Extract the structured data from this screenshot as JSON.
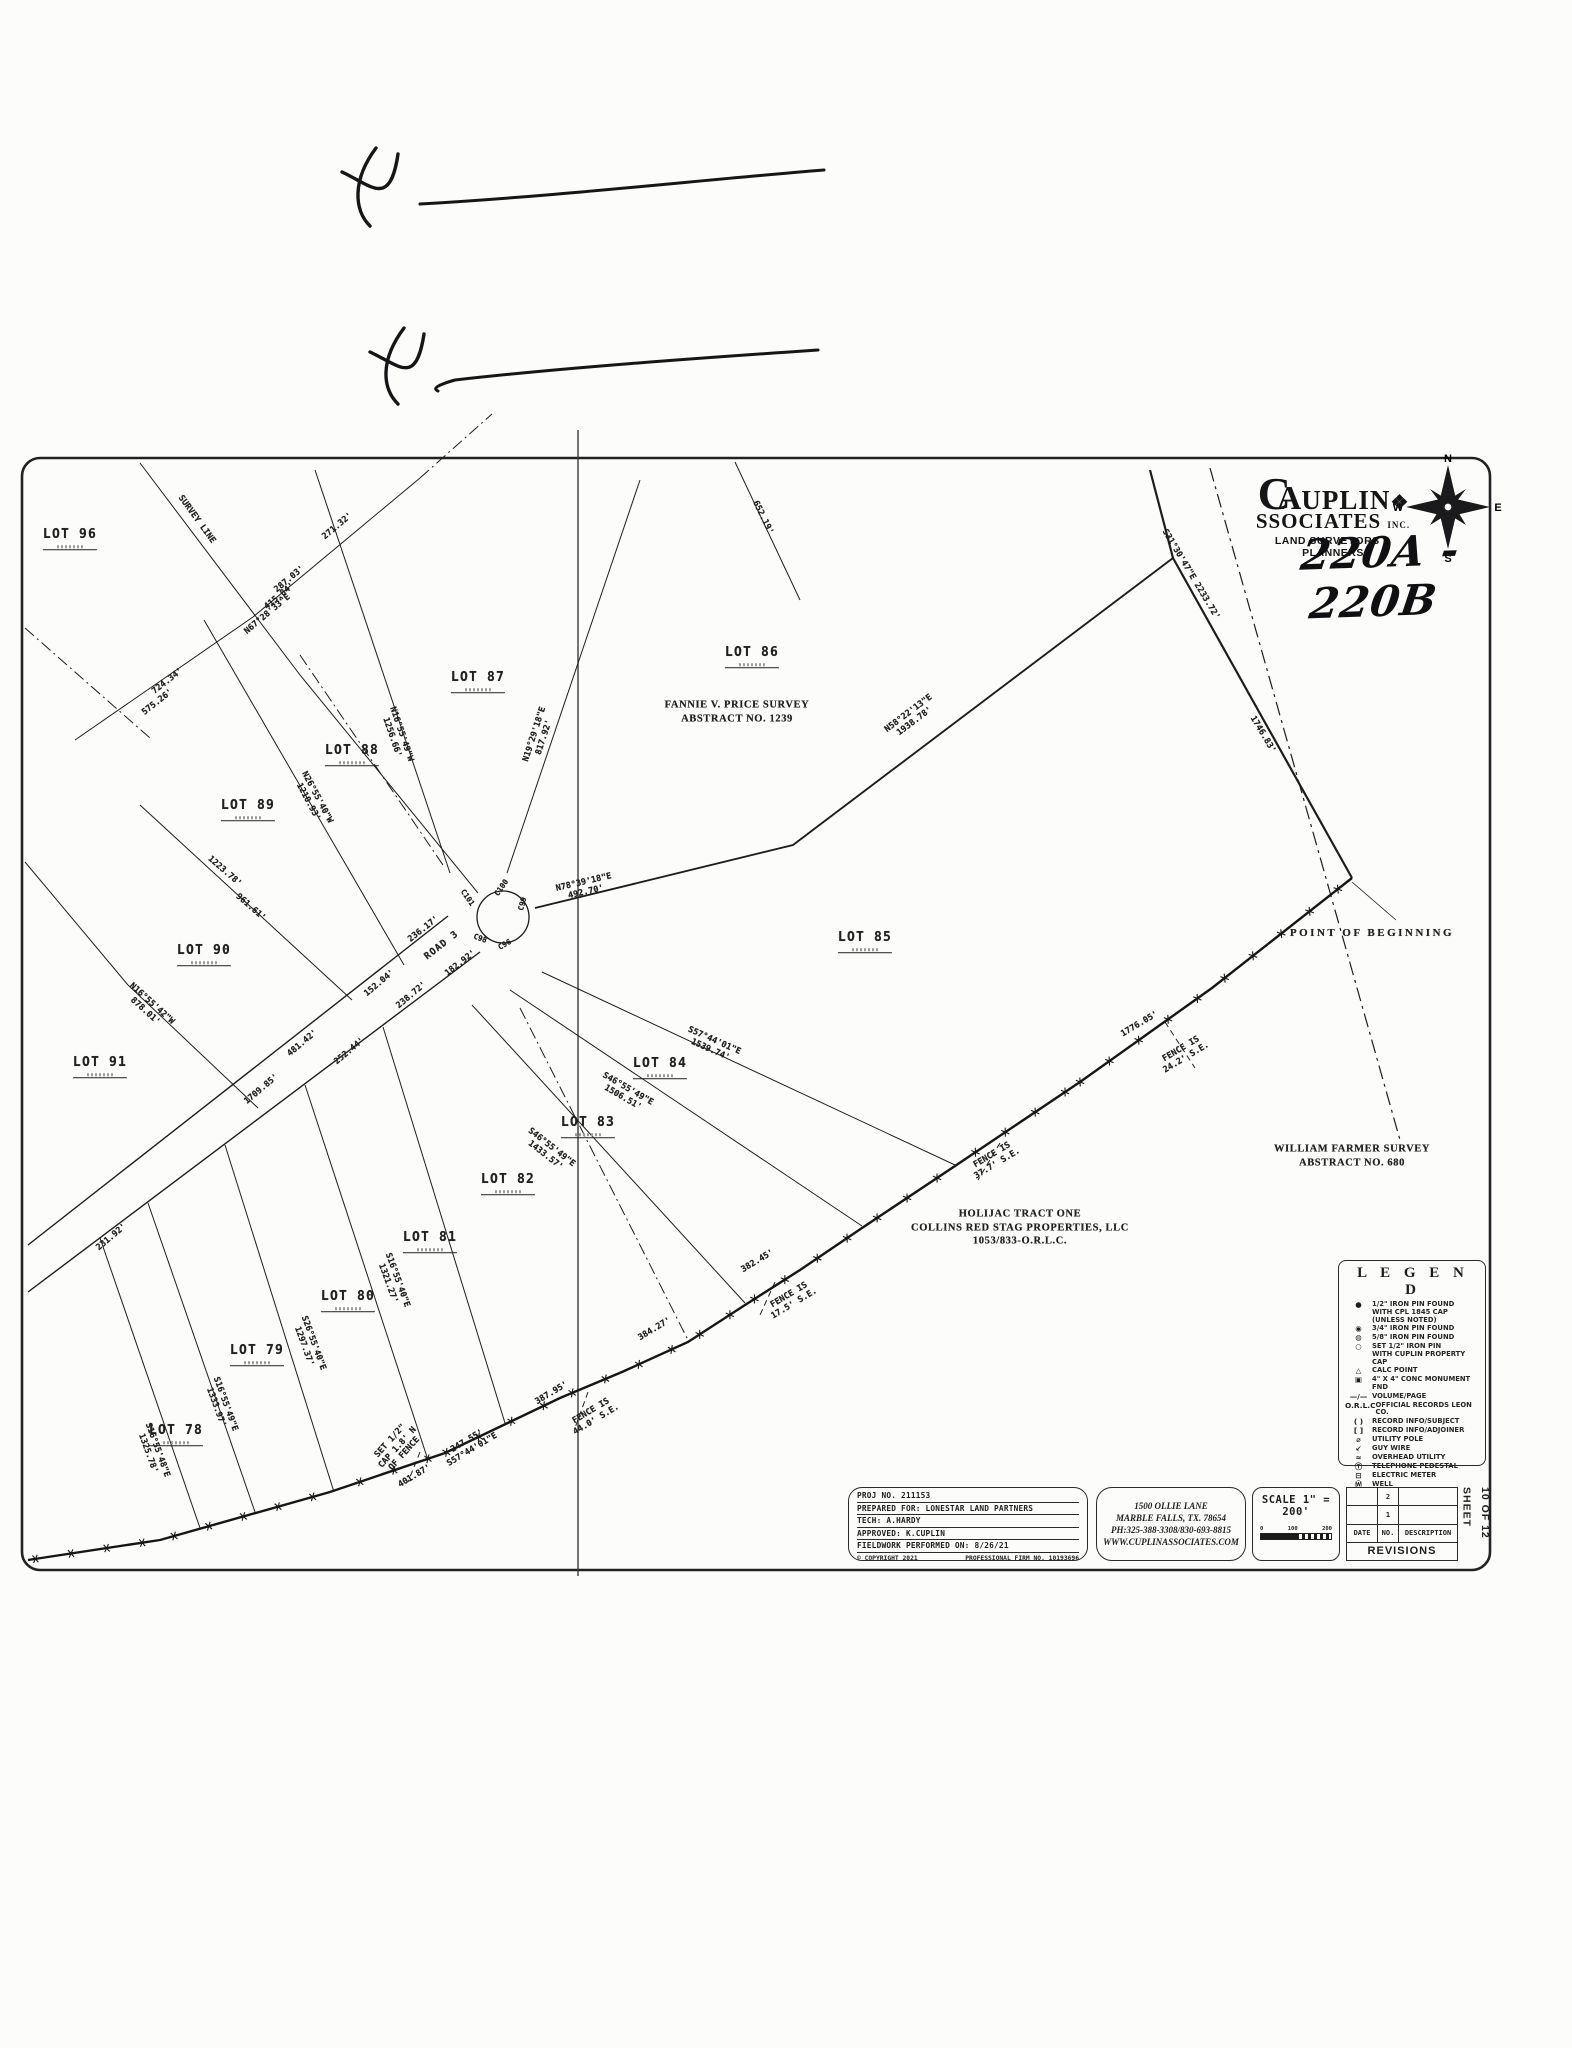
{
  "handwriting": {
    "plat_number": "220A - 220B",
    "x_mark_1": "X",
    "x_mark_2": "X"
  },
  "logo": {
    "monogram_c": "C",
    "monogram_a": "A",
    "name_rest": "UPLIN",
    "glyph": "❖",
    "line2_main": "SSOCIATES",
    "line2_suffix": "INC.",
    "tagline": "LAND SURVEYORS & PLANNERS"
  },
  "compass": {
    "north": "N",
    "south": "S",
    "east": "E",
    "west": "W"
  },
  "map": {
    "labels": [
      {
        "t": "LOT 96",
        "x": 70,
        "y": 539,
        "r": 0,
        "c": "lot"
      },
      {
        "t": "LOT 87",
        "x": 478,
        "y": 682,
        "r": 0,
        "c": "lot"
      },
      {
        "t": "LOT 88",
        "x": 352,
        "y": 755,
        "r": 0,
        "c": "lot"
      },
      {
        "t": "LOT 89",
        "x": 248,
        "y": 810,
        "r": 0,
        "c": "lot"
      },
      {
        "t": "LOT 90",
        "x": 204,
        "y": 955,
        "r": 0,
        "c": "lot"
      },
      {
        "t": "LOT 91",
        "x": 100,
        "y": 1067,
        "r": 0,
        "c": "lot"
      },
      {
        "t": "LOT 86",
        "x": 752,
        "y": 657,
        "r": 0,
        "c": "lot"
      },
      {
        "t": "LOT 85",
        "x": 865,
        "y": 942,
        "r": 0,
        "c": "lot"
      },
      {
        "t": "LOT 84",
        "x": 660,
        "y": 1068,
        "r": 0,
        "c": "lot"
      },
      {
        "t": "LOT 83",
        "x": 588,
        "y": 1127,
        "r": 0,
        "c": "lot"
      },
      {
        "t": "LOT 82",
        "x": 508,
        "y": 1184,
        "r": 0,
        "c": "lot"
      },
      {
        "t": "LOT 81",
        "x": 430,
        "y": 1242,
        "r": 0,
        "c": "lot"
      },
      {
        "t": "LOT 80",
        "x": 348,
        "y": 1301,
        "r": 0,
        "c": "lot"
      },
      {
        "t": "LOT 79",
        "x": 257,
        "y": 1355,
        "r": 0,
        "c": "lot"
      },
      {
        "t": "LOT 78",
        "x": 176,
        "y": 1435,
        "r": 0,
        "c": "lot"
      },
      {
        "t": "SURVEY LINE",
        "x": 196,
        "y": 520,
        "r": 54,
        "c": "b"
      },
      {
        "t": "287.03'",
        "x": 290,
        "y": 580,
        "r": -40,
        "c": "b"
      },
      {
        "t": "415.84'",
        "x": 280,
        "y": 597,
        "r": -40,
        "c": "b"
      },
      {
        "t": "N67°28'33\"E",
        "x": 268,
        "y": 615,
        "r": -40,
        "c": "b"
      },
      {
        "t": "271.32'",
        "x": 338,
        "y": 527,
        "r": -40,
        "c": "b"
      },
      {
        "t": "724.34'",
        "x": 168,
        "y": 682,
        "r": -38,
        "c": "b"
      },
      {
        "t": "575.26'",
        "x": 158,
        "y": 703,
        "r": -38,
        "c": "b"
      },
      {
        "t": "N26°55'40\"W\n1210.93'",
        "x": 312,
        "y": 800,
        "r": 62,
        "c": "b"
      },
      {
        "t": "1223.78'",
        "x": 224,
        "y": 872,
        "r": 41,
        "c": "b"
      },
      {
        "t": "961.61'",
        "x": 250,
        "y": 908,
        "r": 41,
        "c": "b"
      },
      {
        "t": "N16°55'42\"W\n878.01'",
        "x": 148,
        "y": 1008,
        "r": 42,
        "c": "b"
      },
      {
        "t": "152.04'",
        "x": 380,
        "y": 984,
        "r": -40,
        "c": "b"
      },
      {
        "t": "238.72'",
        "x": 412,
        "y": 996,
        "r": -40,
        "c": "b"
      },
      {
        "t": "481.42'",
        "x": 303,
        "y": 1044,
        "r": -40,
        "c": "b"
      },
      {
        "t": "252.44'",
        "x": 350,
        "y": 1052,
        "r": -40,
        "c": "b"
      },
      {
        "t": "1709.85'",
        "x": 262,
        "y": 1090,
        "r": -40,
        "c": "b"
      },
      {
        "t": "N16°55'49\"W\n1256.66'",
        "x": 396,
        "y": 736,
        "r": 71,
        "c": "b"
      },
      {
        "t": "N19°29'18\"E\n817.92'",
        "x": 540,
        "y": 736,
        "r": -72,
        "c": "b"
      },
      {
        "t": "N78°39'18\"E\n492.70'",
        "x": 585,
        "y": 888,
        "r": -13,
        "c": "b"
      },
      {
        "t": "652.19'",
        "x": 762,
        "y": 518,
        "r": 64,
        "c": "b"
      },
      {
        "t": "N58°22'13\"E\n1938.78'",
        "x": 912,
        "y": 718,
        "r": -37,
        "c": "b"
      },
      {
        "t": "S31°30'47\"E 2233.72'",
        "x": 1190,
        "y": 575,
        "r": 59,
        "c": "b"
      },
      {
        "t": "1746.83'",
        "x": 1262,
        "y": 735,
        "r": 59,
        "c": "b"
      },
      {
        "t": "POINT OF BEGINNING",
        "x": 1372,
        "y": 933,
        "r": 0,
        "c": "pob"
      },
      {
        "t": "1776.05'",
        "x": 1140,
        "y": 1025,
        "r": -31,
        "c": "b"
      },
      {
        "t": "FENCE IS\n24.2' S.E.",
        "x": 1184,
        "y": 1054,
        "r": -31,
        "c": "b"
      },
      {
        "t": "FENCE IS\n37.7' S.E.",
        "x": 995,
        "y": 1160,
        "r": -31,
        "c": "b"
      },
      {
        "t": "382.45'",
        "x": 758,
        "y": 1262,
        "r": -31,
        "c": "b"
      },
      {
        "t": "FENCE IS\n17.5' S.E.",
        "x": 792,
        "y": 1300,
        "r": -31,
        "c": "b"
      },
      {
        "t": "384.27'",
        "x": 655,
        "y": 1330,
        "r": -31,
        "c": "b"
      },
      {
        "t": "387.95'",
        "x": 552,
        "y": 1394,
        "r": -31,
        "c": "b"
      },
      {
        "t": "FENCE IS\n44.0' S.E.",
        "x": 594,
        "y": 1416,
        "r": -31,
        "c": "b"
      },
      {
        "t": "SET 1/2\"\nCAP 1.8' N\nOF FENCE",
        "x": 398,
        "y": 1448,
        "r": -48,
        "c": "b"
      },
      {
        "t": "247.55'\nS57°44'01\"E",
        "x": 470,
        "y": 1446,
        "r": -31,
        "c": "b"
      },
      {
        "t": "401.87'",
        "x": 415,
        "y": 1477,
        "r": -31,
        "c": "b"
      },
      {
        "t": "S16°55'40\"E\n1321.27'",
        "x": 392,
        "y": 1282,
        "r": 70,
        "c": "b"
      },
      {
        "t": "S26°55'40\"E\n1297.37'",
        "x": 308,
        "y": 1345,
        "r": 70,
        "c": "b"
      },
      {
        "t": "S16°55'49\"E\n1333.97'",
        "x": 220,
        "y": 1406,
        "r": 70,
        "c": "b"
      },
      {
        "t": "S16°55'48\"E\n1325.78'",
        "x": 152,
        "y": 1452,
        "r": 70,
        "c": "b"
      },
      {
        "t": "231.92'",
        "x": 112,
        "y": 1238,
        "r": -40,
        "c": "b"
      },
      {
        "t": "S57°44'01\"E\n1539.74'",
        "x": 712,
        "y": 1046,
        "r": 24,
        "c": "b"
      },
      {
        "t": "S46°55'49\"E\n1506.51'",
        "x": 625,
        "y": 1094,
        "r": 30,
        "c": "b"
      },
      {
        "t": "S46°55'49\"E\n1433.57'",
        "x": 548,
        "y": 1152,
        "r": 38,
        "c": "b"
      },
      {
        "t": "ROAD 3",
        "x": 442,
        "y": 946,
        "r": -38,
        "c": "road"
      },
      {
        "t": "182.92'",
        "x": 461,
        "y": 964,
        "r": -38,
        "c": "b"
      },
      {
        "t": "236.17'",
        "x": 424,
        "y": 930,
        "r": -38,
        "c": "b"
      },
      {
        "t": "C101",
        "x": 467,
        "y": 898,
        "r": 55,
        "c": "c"
      },
      {
        "t": "C100",
        "x": 502,
        "y": 888,
        "r": -55,
        "c": "c"
      },
      {
        "t": "C99",
        "x": 523,
        "y": 904,
        "r": -75,
        "c": "c"
      },
      {
        "t": "C98",
        "x": 480,
        "y": 939,
        "r": 20,
        "c": "c"
      },
      {
        "t": "C96",
        "x": 505,
        "y": 945,
        "r": -30,
        "c": "c"
      },
      {
        "t": "FANNIE V. PRICE SURVEY\nABSTRACT NO. 1239",
        "x": 737,
        "y": 712,
        "r": 0,
        "c": "survey"
      },
      {
        "t": "WILLIAM FARMER SURVEY\nABSTRACT NO. 680",
        "x": 1352,
        "y": 1156,
        "r": 0,
        "c": "survey"
      },
      {
        "t": "HOLIJAC TRACT ONE\nCOLLINS RED STAG PROPERTIES, LLC\n1053/833-O.R.L.C.",
        "x": 1020,
        "y": 1228,
        "r": 0,
        "c": "survey"
      }
    ]
  },
  "legend": {
    "title": "L E G E N D",
    "items": [
      {
        "sym": "●",
        "text": "1/2\" IRON PIN FOUND\nWITH CPL 1845 CAP\n(UNLESS NOTED)"
      },
      {
        "sym": "◉",
        "text": "3/4\" IRON PIN FOUND"
      },
      {
        "sym": "◍",
        "text": "5/8\" IRON PIN FOUND"
      },
      {
        "sym": "○",
        "text": "SET 1/2\" IRON PIN\nWITH CUPLIN PROPERTY CAP"
      },
      {
        "sym": "△",
        "text": "CALC POINT"
      },
      {
        "sym": "▣",
        "text": "4\" X 4\" CONC MONUMENT FND"
      },
      {
        "sym": "—/—",
        "text": "VOLUME/PAGE"
      },
      {
        "sym": "O.R.L.C",
        "text": "OFFICIAL RECORDS LEON CO."
      },
      {
        "sym": "( )",
        "text": "RECORD INFO/SUBJECT"
      },
      {
        "sym": "[ ]",
        "text": "RECORD INFO/ADJOINER"
      },
      {
        "sym": "⌀",
        "text": "UTILITY POLE"
      },
      {
        "sym": "↙",
        "text": "GUY WIRE"
      },
      {
        "sym": "≈",
        "text": "OVERHEAD UTILITY"
      },
      {
        "sym": "Ⓣ",
        "text": "TELEPHONE PEDESTAL"
      },
      {
        "sym": "⊟",
        "text": "ELECTRIC METER"
      },
      {
        "sym": "Ⓦ",
        "text": "WELL"
      },
      {
        "sym": "—x—",
        "text": "WIRE FENCE"
      },
      {
        "sym": "■",
        "text": "SIGN"
      }
    ]
  },
  "title_block": {
    "info_rows": [
      "PROJ NO. 211153",
      "PREPARED FOR: LONESTAR LAND PARTNERS",
      "TECH: A.HARDY",
      "APPROVED: K.CUPLIN",
      "FIELDWORK PERFORMED ON: 8/26/21"
    ],
    "info_footer_left": "© COPYRIGHT 2021",
    "info_footer_right": "PROFESSIONAL FIRM NO. 10193696",
    "address_lines": [
      "1500 OLLIE LANE",
      "MARBLE FALLS, TX. 78654",
      "PH:325-388-3308/830-693-8815",
      "WWW.CUPLINASSOCIATES.COM"
    ],
    "scale": {
      "label": "SCALE 1\" = 200'",
      "ticks": [
        "0",
        "100",
        "200"
      ]
    },
    "revisions": {
      "columns": [
        "DATE",
        "NO.",
        "DESCRIPTION"
      ],
      "row_numbers": [
        "2",
        "1"
      ],
      "title": "REVISIONS"
    },
    "sheet": {
      "label": "SHEET",
      "number": "10 OF 12"
    }
  }
}
